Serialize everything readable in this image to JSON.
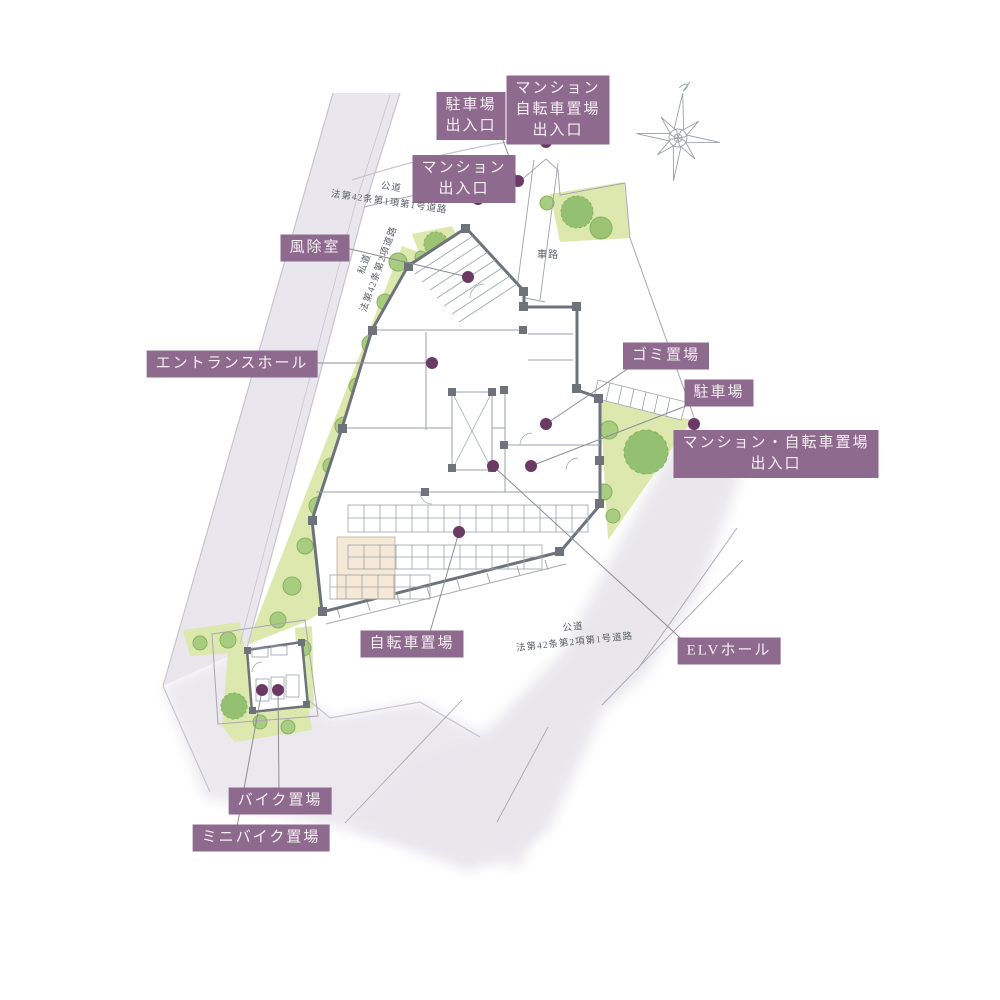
{
  "labels": {
    "parking_entrance": "駐車場\n出入口",
    "mansion_bicycle_entrance": "マンション\n自転車置場\n出入口",
    "mansion_entrance": "マンション\n出入口",
    "windbreak_room": "風除室",
    "entrance_hall": "エントランスホール",
    "garbage_area": "ゴミ置場",
    "parking_area": "駐車場",
    "mansion_bicycle_entrance_2": "マンション・自転車置場\n出入口",
    "bicycle_parking": "自転車置場",
    "elv_hall": "ELVホール",
    "bike_parking": "バイク置場",
    "mini_bike_parking": "ミニバイク置場"
  },
  "road_labels": {
    "north_road": "公道\n法第42条第1項第1号道路",
    "west_road": "私道\n法第42条第2項道路",
    "south_road": "公道\n法第42条第2項第1号道路",
    "driveway": "車路"
  },
  "colors": {
    "label_bg": "#8e6b8e",
    "label_text": "#f6eef3",
    "leader_dot": "#6a3a64",
    "road_fill": "#e8e6ec",
    "green_fill": "#dde8ae",
    "tree_green": "#a8cc80",
    "wall_gray": "#6e737b",
    "beige_room": "#f6e8d7"
  }
}
